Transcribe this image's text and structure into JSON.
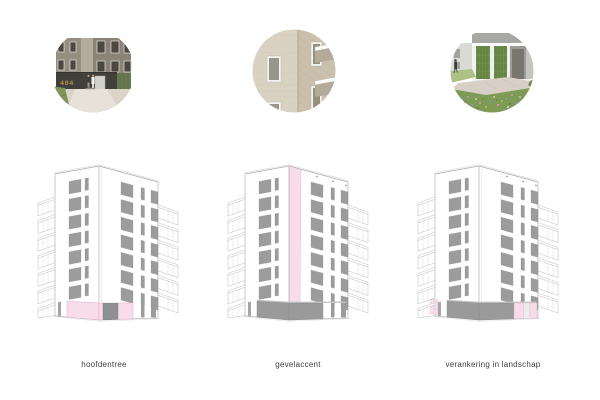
{
  "page": {
    "background": "#ffffff"
  },
  "columns": [
    {
      "label": "hoofdentree",
      "variant": "entrance",
      "photo": "entrance-street-view",
      "building_number": "484"
    },
    {
      "label": "gevelaccent",
      "variant": "accent",
      "photo": "facade-brick-detail"
    },
    {
      "label": "verankering in landschap",
      "variant": "landscape",
      "photo": "green-wall-garden-view"
    }
  ],
  "colors": {
    "accent_pink": "#f8dce9",
    "accent_pink_line": "#ddaec7",
    "window_gray": "#9c9c9c",
    "plinth_gray": "#9a9a9a",
    "plinth_top": "#c8c8c8",
    "door_gray": "#8f9094",
    "line_gray": "#b5b5b5",
    "label_text": "#3f3f3f"
  }
}
